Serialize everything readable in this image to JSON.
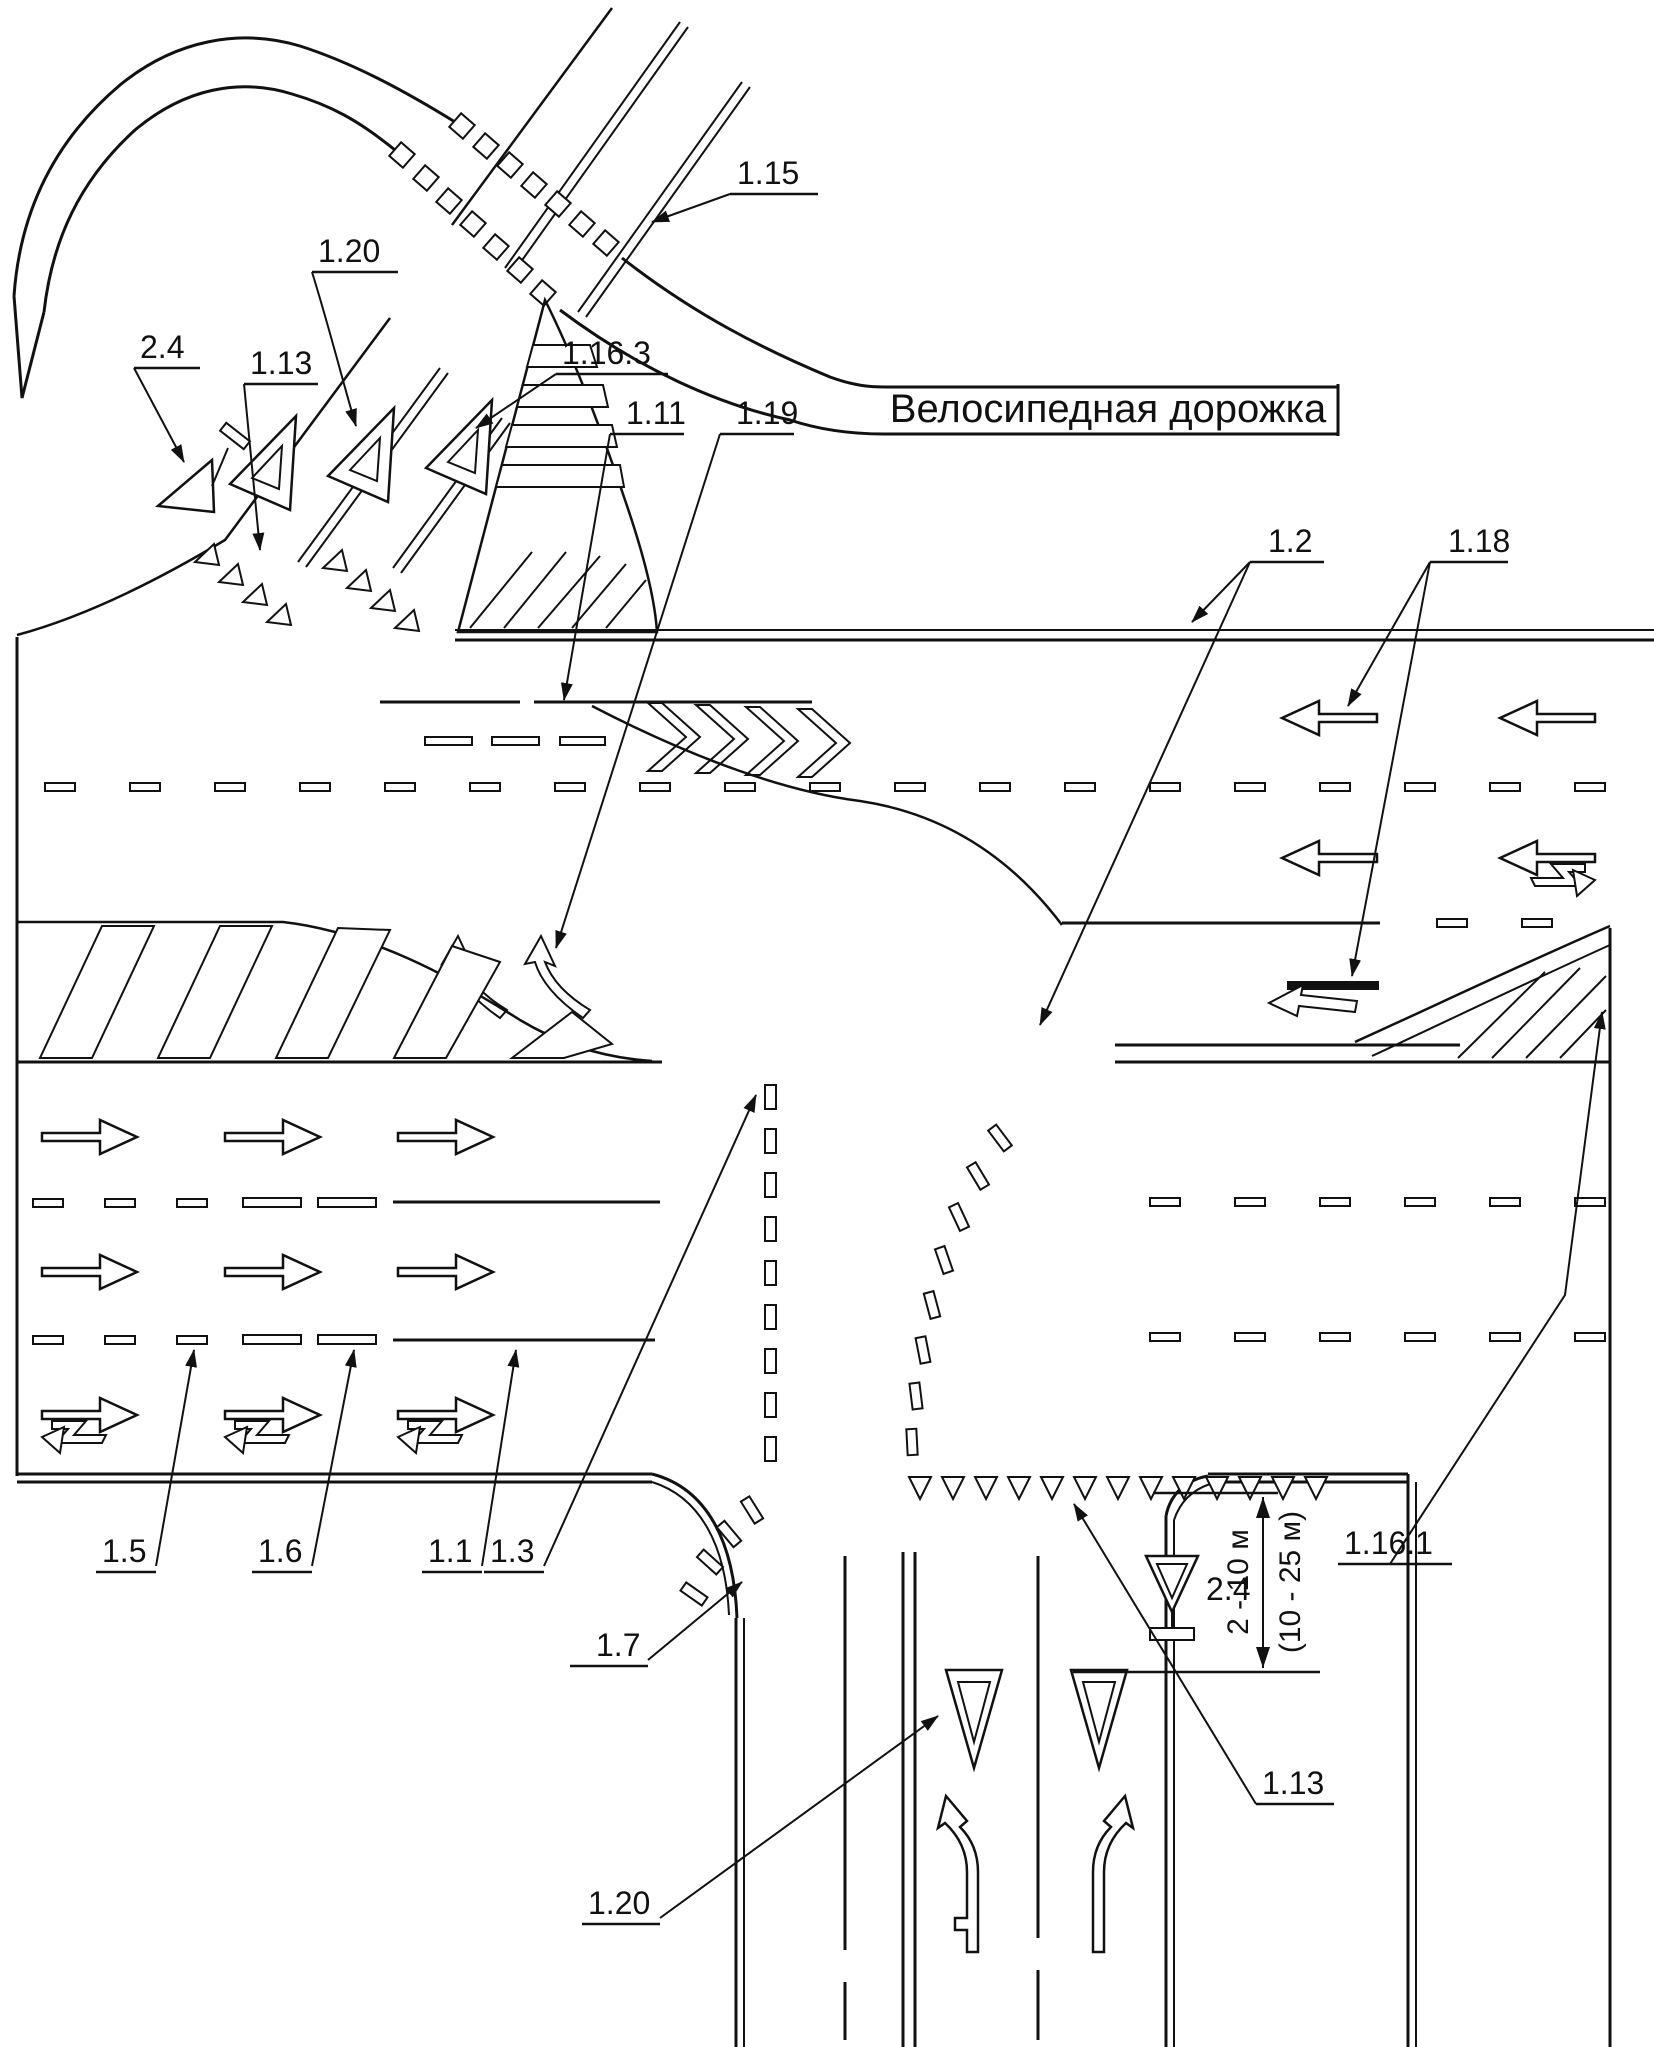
{
  "diagram": {
    "bike_path_text": "Велосипедная дорожка",
    "labels": {
      "l_1_15": "1.15",
      "l_1_20_top": "1.20",
      "l_2_4_top": "2.4",
      "l_1_13_top": "1.13",
      "l_1_16_3": "1.16.3",
      "l_1_11": "1.11",
      "l_1_19": "1.19",
      "l_1_2": "1.2",
      "l_1_18": "1.18",
      "l_1_5": "1.5",
      "l_1_6": "1.6",
      "l_1_1": "1.1",
      "l_1_3": "1.3",
      "l_1_7": "1.7",
      "l_1_20_bottom": "1.20",
      "l_1_13_bottom": "1.13",
      "l_2_4_bottom": "2.4",
      "l_1_16_1": "1.16.1"
    },
    "dimensions": {
      "primary": "2 - 10 м",
      "secondary": "(10 - 25 м)"
    },
    "colors": {
      "ink": "#111111",
      "background": "#ffffff"
    }
  }
}
